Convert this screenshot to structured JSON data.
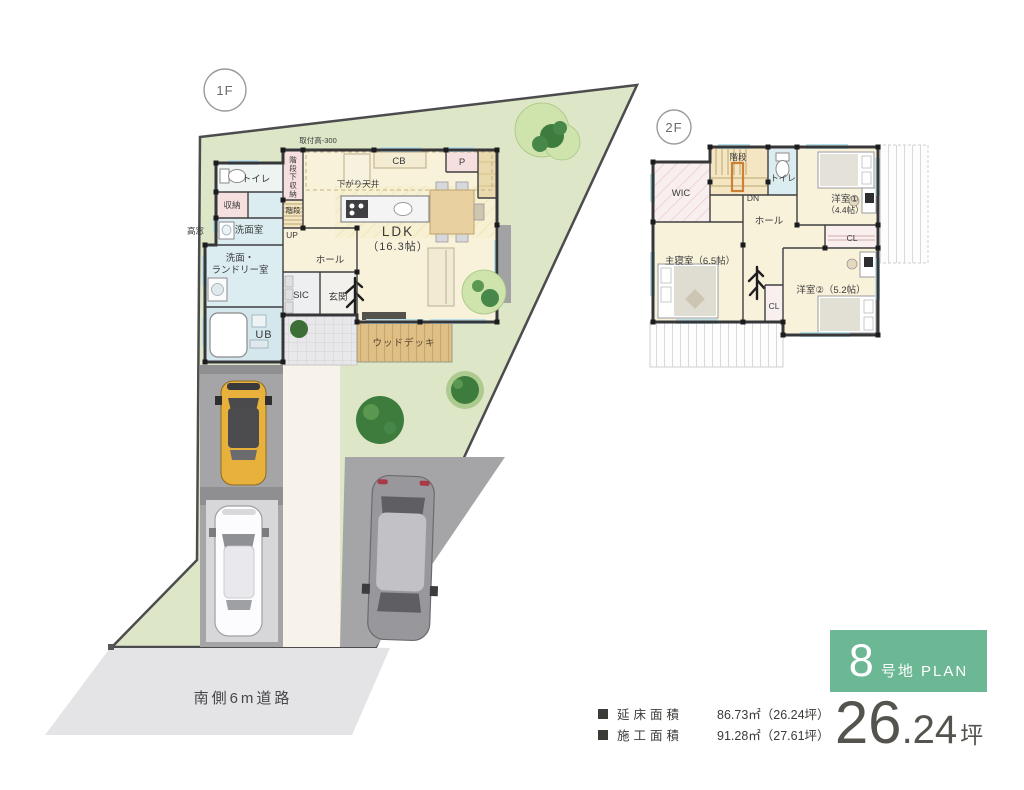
{
  "floor1": {
    "badge": "1F",
    "rooms": {
      "toritsuke": "取付高-300",
      "toilet": "トイレ",
      "stair_storage": "階段下収納",
      "cb": "CB",
      "p": "P",
      "lowered_ceiling": "下がり天井",
      "storage": "収納",
      "stairs": "階段",
      "up": "UP",
      "high_window": "高窓",
      "washroom": "洗面室",
      "laundry_line1": "洗面・",
      "laundry_line2": "ランドリー室",
      "hall": "ホール",
      "sic": "SIC",
      "entrance": "玄関",
      "ub": "UB",
      "ldk_line1": "LDK",
      "ldk_line2": "（16.3帖）",
      "wood_deck": "ウッドデッキ"
    }
  },
  "floor2": {
    "badge": "2F",
    "rooms": {
      "stairs": "階段",
      "toilet": "トイレ",
      "wic": "WIC",
      "dn": "DN",
      "hall": "ホール",
      "bedroom1_line1": "洋室①",
      "bedroom1_line2": "（4.4帖）",
      "cl1": "CL",
      "master": "主寝室（6.5帖）",
      "cl2": "CL",
      "bedroom2": "洋室②（5.2帖）"
    }
  },
  "site": {
    "road_label": "南側6m道路"
  },
  "info": {
    "accent_color": "#6cb794",
    "plan_number": "8",
    "plan_suffix": "号地 PLAN",
    "tsubo_int": "26",
    "tsubo_frac": ".24",
    "tsubo_unit": "坪",
    "rows": [
      {
        "label": "延床面積",
        "value": "86.73㎡（26.24坪）"
      },
      {
        "label": "施工面積",
        "value": "91.28㎡（27.61坪）"
      }
    ]
  },
  "colors": {
    "lawn": "#dde7c8",
    "road": "#e4e4e6",
    "floor": "#f9f2db",
    "sanitary_blue": "#dcedf1",
    "closet_pink": "#f6dfdf",
    "deck": "#e0bf86",
    "tree_dark": "#3e7c3e",
    "tree_light": "#cfe3ac"
  }
}
